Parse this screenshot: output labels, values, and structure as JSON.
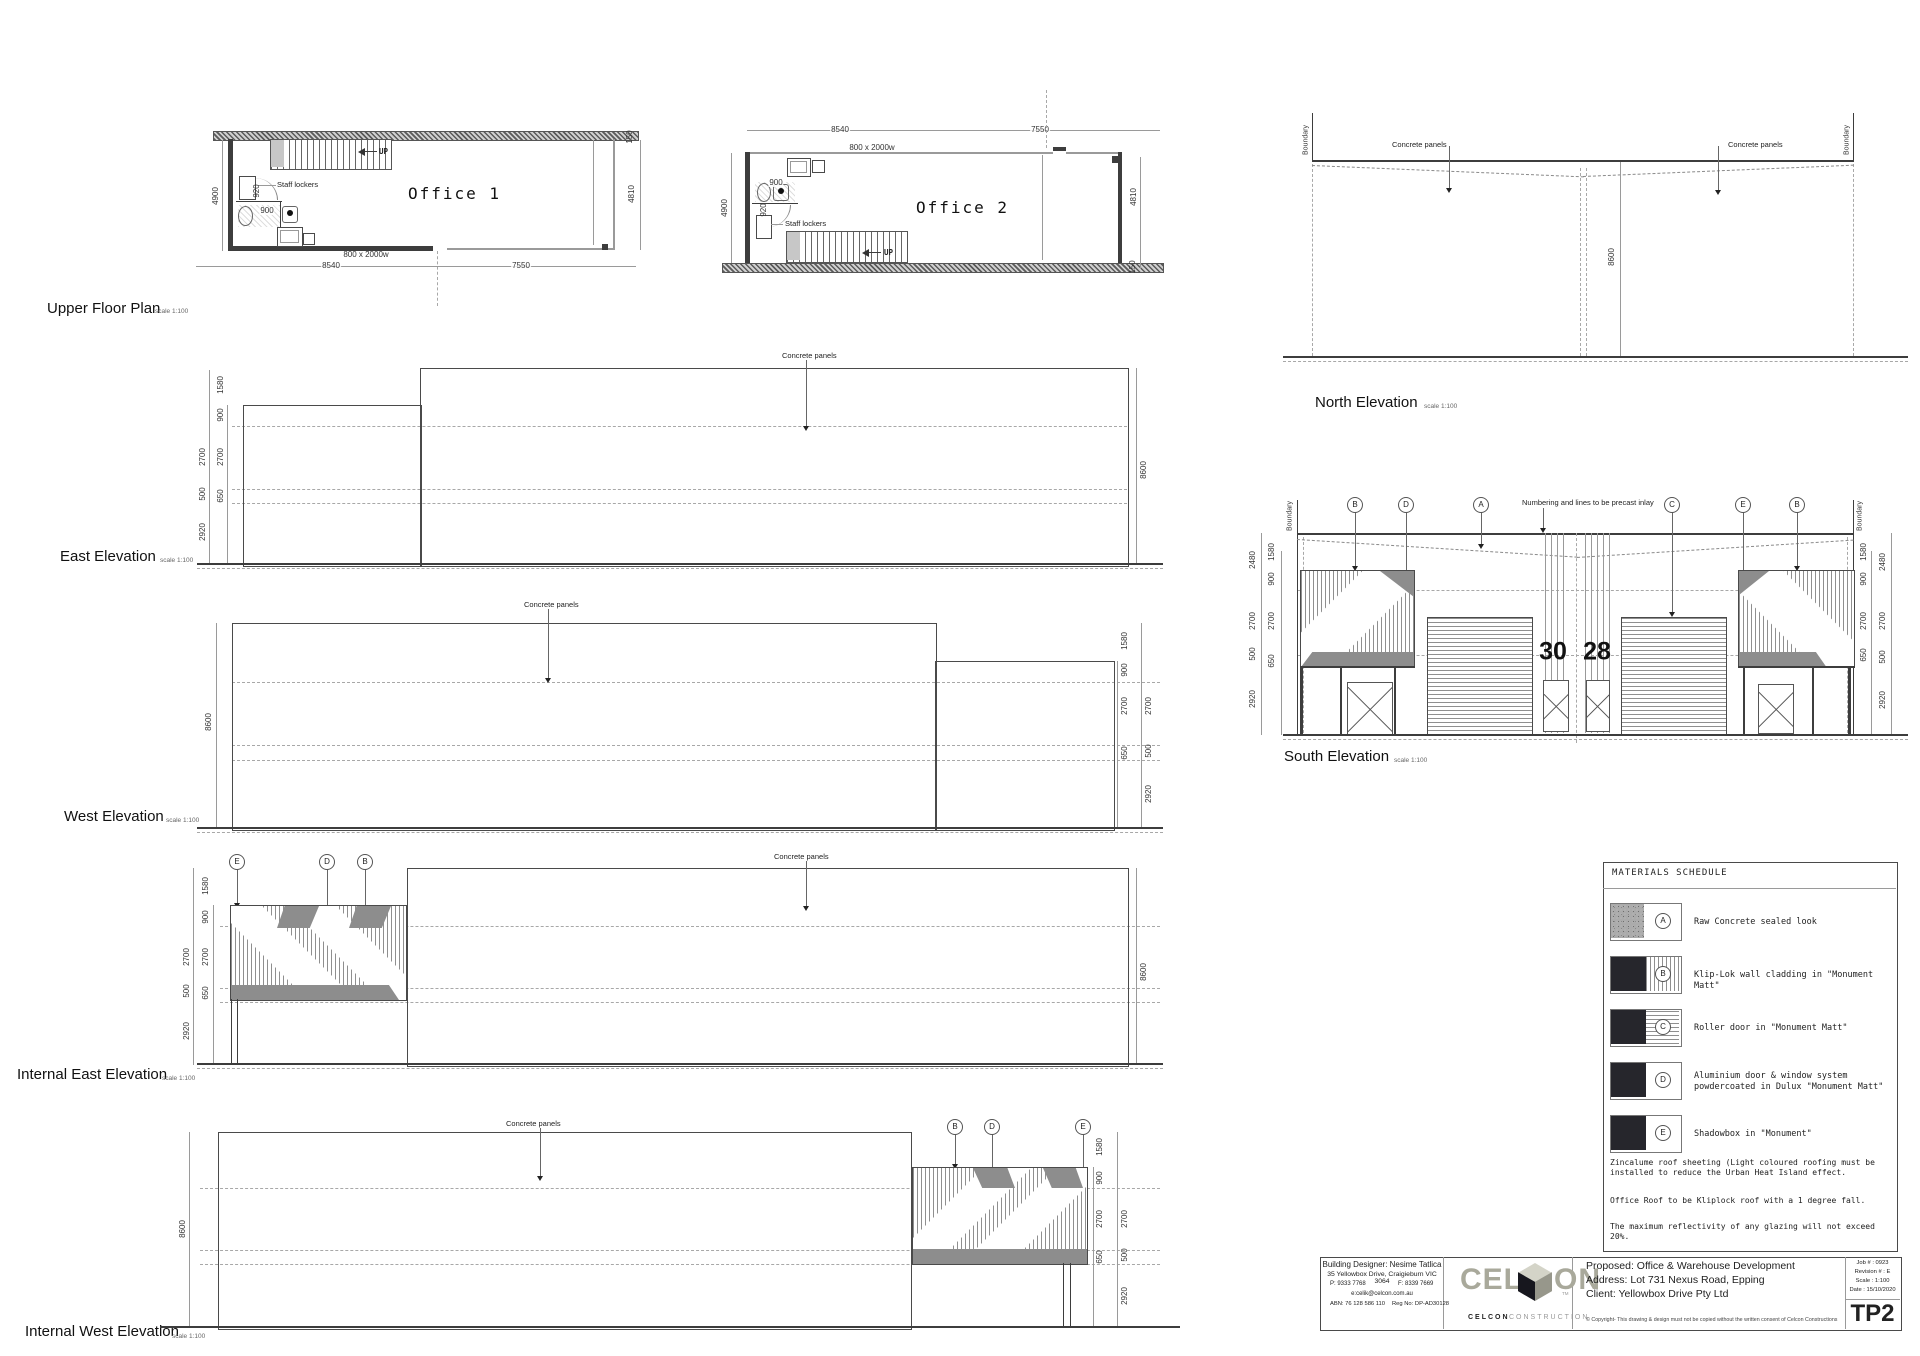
{
  "sheet": {
    "scale": "scale 1:100"
  },
  "titles": {
    "plan": "Upper Floor Plan",
    "office1": "Office 1",
    "office2": "Office 2",
    "north": "North Elevation",
    "south": "South Elevation",
    "east": "East Elevation",
    "west": "West Elevation",
    "internal_east": "Internal East Elevation",
    "internal_west": "Internal West Elevation"
  },
  "labels": {
    "concrete_panels": "Concrete panels",
    "boundary": "Boundary",
    "staff_lockers": "Staff lockers",
    "up": "UP",
    "door_size": "800 x 2000w",
    "numbering_note": "Numbering and lines to be precast inlay",
    "num30": "30",
    "num28": "28"
  },
  "dims": {
    "d150": "150",
    "d500": "500",
    "d650": "650",
    "d900": "900",
    "d920": "920",
    "d1580": "1580",
    "d2480": "2480",
    "d2700": "2700",
    "d2920": "2920",
    "d4810": "4810",
    "d4900": "4900",
    "d7550": "7550",
    "d8540": "8540",
    "d8600": "8600"
  },
  "markers": {
    "a": "A",
    "b": "B",
    "c": "C",
    "d": "D",
    "e": "E"
  },
  "materials_schedule": {
    "title": "MATERIALS SCHEDULE",
    "items": [
      {
        "key": "A",
        "label": "Raw Concrete sealed look"
      },
      {
        "key": "B",
        "label": "Klip-Lok wall cladding in \"Monument Matt\""
      },
      {
        "key": "C",
        "label": "Roller door in \"Monument Matt\""
      },
      {
        "key": "D",
        "label": "Aluminium door & window system powdercoated in Dulux \"Monument Matt\""
      },
      {
        "key": "E",
        "label": "Shadowbox in \"Monument\""
      }
    ],
    "notes": [
      "Zincalume roof sheeting (Light coloured roofing must be installed to reduce the Urban Heat Island effect.",
      "Office Roof to be Kliplock roof with a 1 degree fall.",
      "The maximum reflectivity of any glazing will not exceed 20%."
    ]
  },
  "title_block": {
    "designer_line1": "Building Designer: Nesime Tatlica",
    "designer_line2": "35 Yellowbox Drive, Craigieburn VIC 3064",
    "phone": "P: 9333 7768",
    "fax": "F: 8339 7669",
    "email": "e:celik@celcon.com.au",
    "abn": "ABN: 76 128 586 110",
    "reg": "Reg No: DP-AD30128",
    "logo_pre": "CEL",
    "logo_post": "ON",
    "logo_tm": "TM",
    "logo_sub_bold": "CELCON",
    "logo_sub_light": "CONSTRUCTION",
    "proposed": "Proposed: Office & Warehouse Development",
    "address": "Address: Lot 731 Nexus Road, Epping",
    "client": "Client: Yellowbox Drive Pty Ltd",
    "copyright": "© Copyright- This drawing & design must not be copied without the written consent of Celcon Constructions",
    "job": "Job # : 0923",
    "revision": "Revision # : E",
    "scale_line": "Scale : 1:100",
    "date": "Date : 15/10/2020",
    "sheet_no": "TP2"
  }
}
